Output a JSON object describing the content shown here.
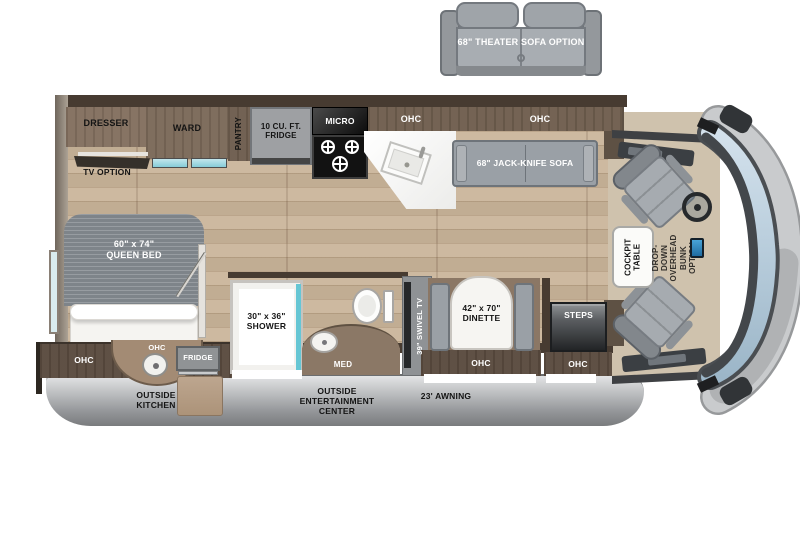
{
  "floorplan": {
    "type": "RV motorhome floor plan (top view)",
    "options": {
      "theater_sofa": "68\" THEATER SOFA OPTION",
      "tv_option": "TV OPTION",
      "overhead_bunk": "DROP-DOWN\nOVERHEAD BUNK\nOPTION"
    },
    "bedroom": {
      "bed": "60\" x 74\"\nQUEEN BED",
      "dresser": "DRESSER",
      "ward": "WARD",
      "ohc": "OHC"
    },
    "kitchen": {
      "pantry": "PANTRY",
      "fridge": "10 CU. FT.\nFRIDGE",
      "micro": "MICRO",
      "ohc_left": "OHC",
      "ohc_right": "OHC"
    },
    "bathroom": {
      "shower": "30\" x 36\"\nSHOWER",
      "med": "MED"
    },
    "living": {
      "jack_knife_sofa": "68\" JACK-KNIFE SOFA",
      "swivel_tv": "39\" SWIVEL TV",
      "dinette": "42\" x 70\"\nDINETTE",
      "dinette_ohc": "OHC"
    },
    "entry": {
      "steps": "STEPS",
      "ohc": "OHC"
    },
    "cockpit": {
      "table": "COCKPIT\nTABLE"
    },
    "exterior": {
      "outside_kitchen": "OUTSIDE\nKITCHEN",
      "outside_kitchen_ohc": "OHC",
      "outside_fridge": "FRIDGE",
      "outside_entertainment": "OUTSIDE\nENTERTAINMENT\nCENTER",
      "awning": "23' AWNING"
    },
    "colors": {
      "floor_wood": "#c9b499",
      "wall_dark": "#473b31",
      "cabinet_brown": "#7b6959",
      "furniture_gray": "#9aa0a6",
      "accent_teal": "#66c6d4",
      "windshield_blue": "#b7ccdb",
      "skirt_gray": "#a8aaac"
    }
  }
}
